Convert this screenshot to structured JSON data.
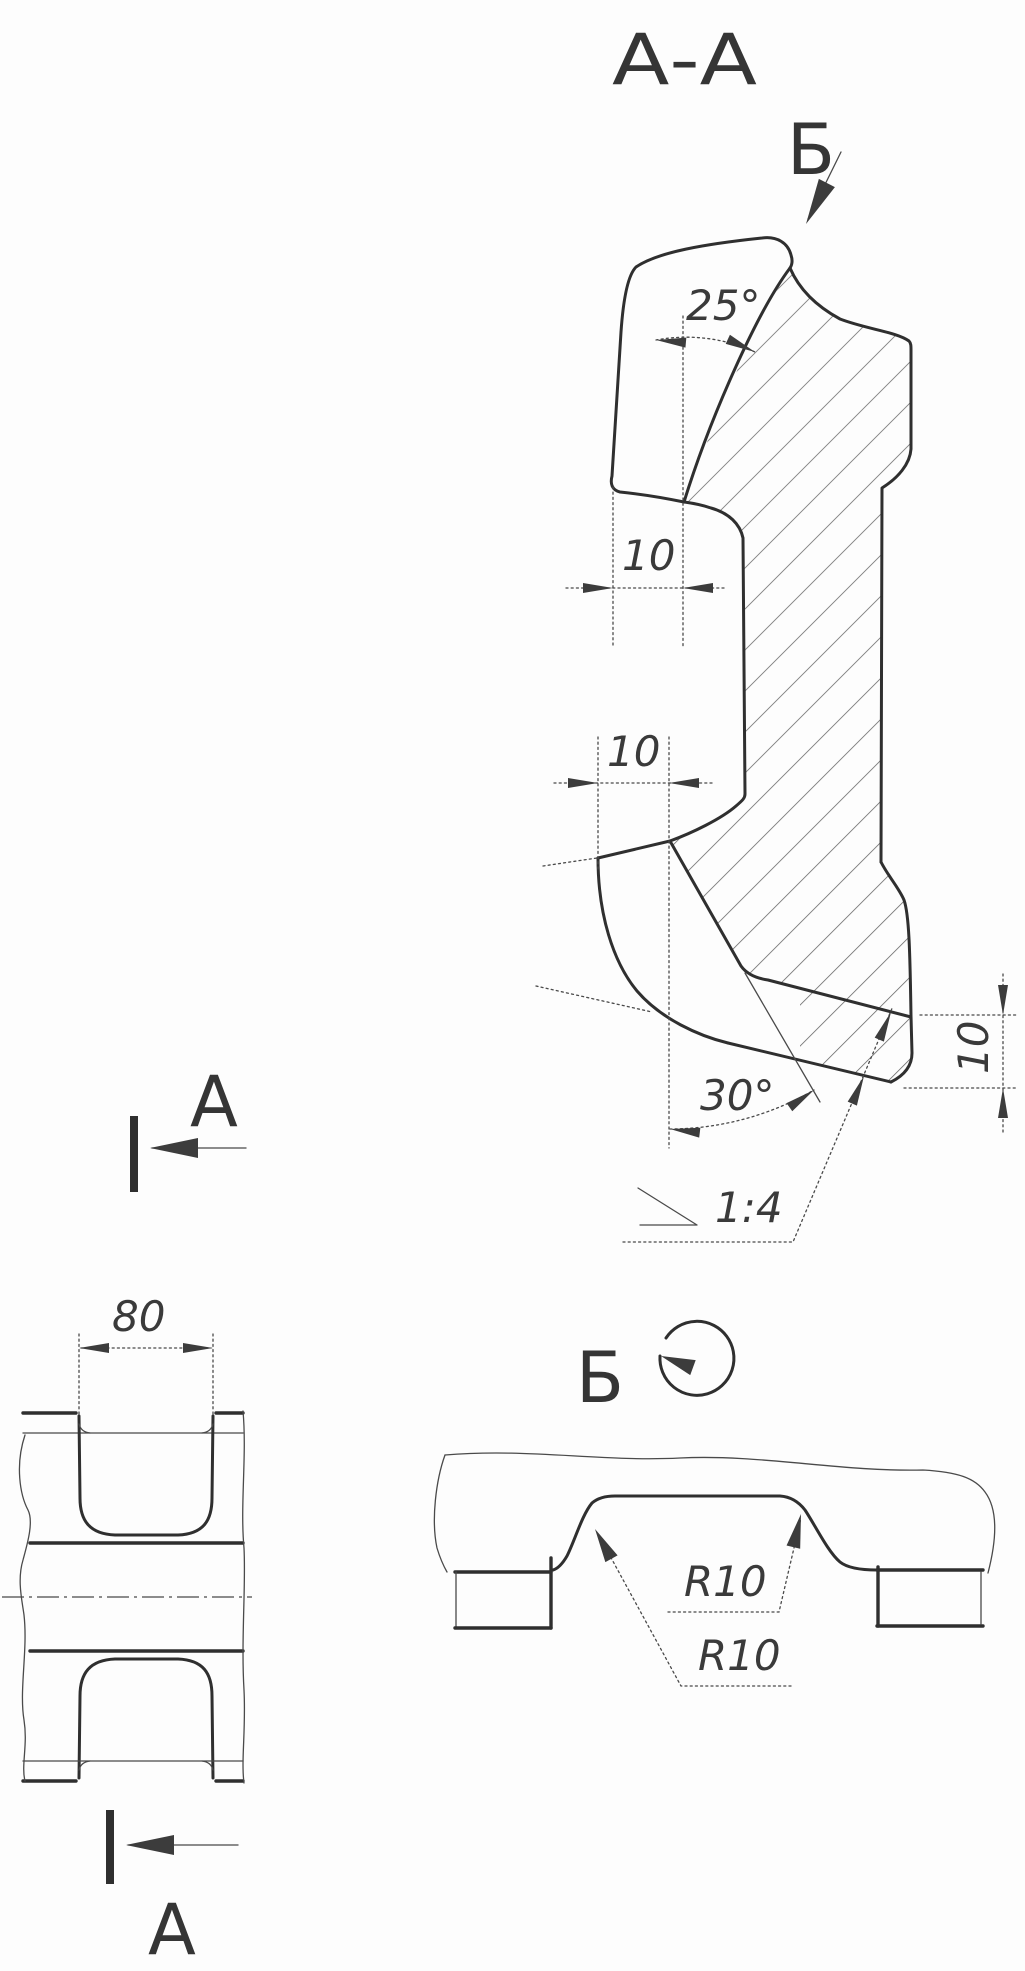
{
  "drawing": {
    "section_title": "А-А",
    "view_b_arrow_label": "Б",
    "rotated_view_label": "Б",
    "section_marker_label": "А",
    "dimensions": {
      "head_cut_angle": "25°",
      "head_remainder_width": "10",
      "web_remainder_width": "10",
      "base_cut_angle": "30°",
      "base_slope": "1:4",
      "base_edge_thickness": "10",
      "groove_width": "80",
      "radius_right": "R10",
      "radius_left": "R10"
    },
    "colors": {
      "ink": "#2f2f2f",
      "paper": "#fdfdfd"
    }
  }
}
